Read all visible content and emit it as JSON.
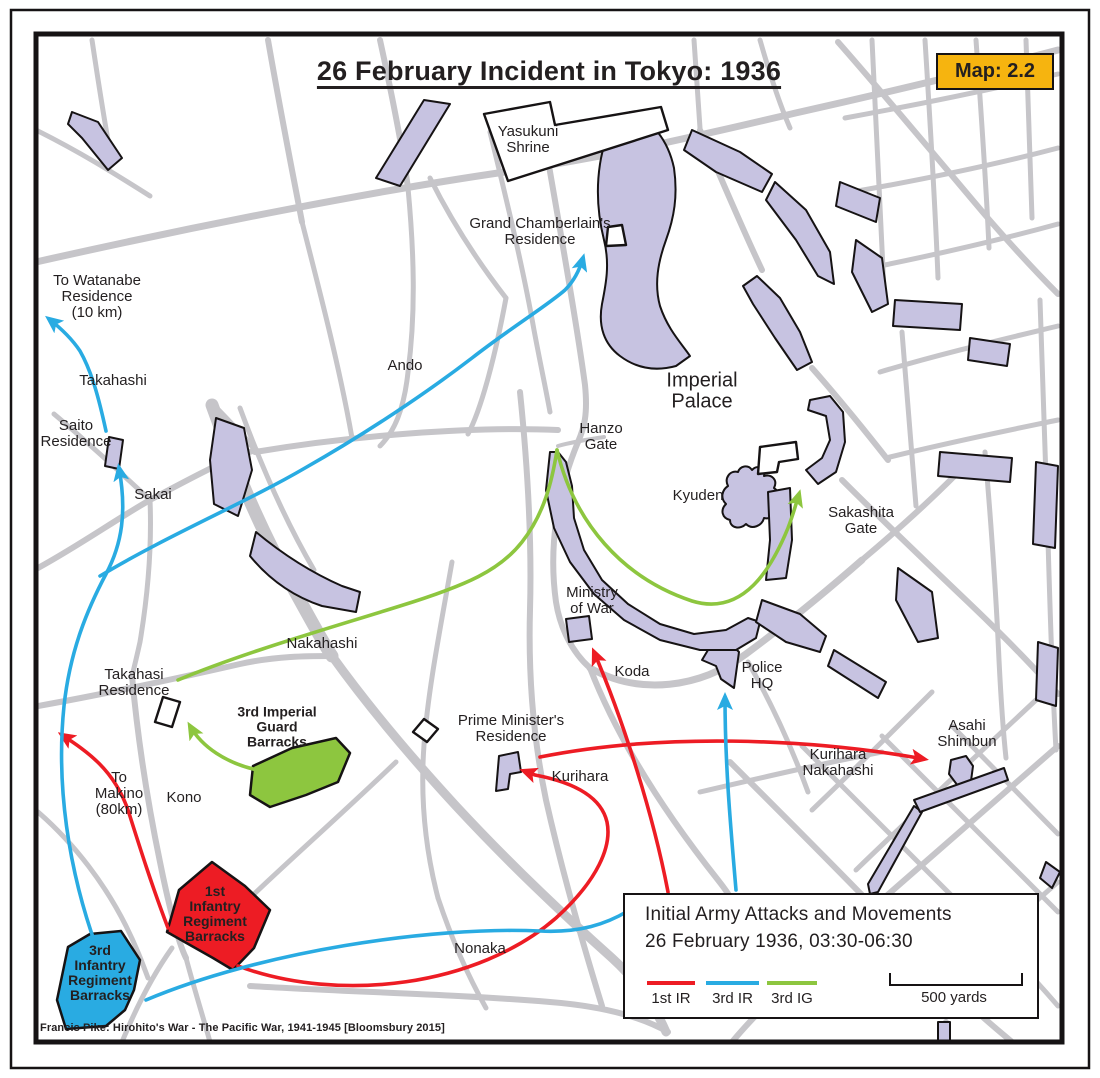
{
  "title": "26 February Incident in Tokyo: 1936",
  "badge": "Map: 2.2",
  "attribution": "Francis Pike:  Hirohito's War - The Pacific War, 1941-1945   [Bloomsbury 2015]",
  "colors": {
    "red": "#ed1c24",
    "blue": "#29abe2",
    "green": "#8dc63f",
    "lav": "#c7c3e1",
    "road": "#c6c5c9",
    "badge": "#f6b40f",
    "ink": "#231f20"
  },
  "legend": {
    "title_line1": "Initial Army Attacks and Movements",
    "title_line2": "26 February 1936, 03:30-06:30",
    "items": [
      {
        "label": "1st IR",
        "color": "red"
      },
      {
        "label": "3rd IR",
        "color": "blue"
      },
      {
        "label": "3rd IG",
        "color": "green"
      }
    ],
    "scale_label": "500 yards"
  },
  "labels": [
    {
      "name": "yasukuni-shrine",
      "text": "Yasukuni\nShrine",
      "x": 528,
      "y": 140
    },
    {
      "name": "grand-chamberlains-residence",
      "text": "Grand Chamberlain's\nResidence",
      "x": 540,
      "y": 232
    },
    {
      "name": "to-watanabe-residence",
      "text": "To Watanabe\nResidence\n(10 km)",
      "x": 97,
      "y": 297
    },
    {
      "name": "takahashi",
      "text": "Takahashi",
      "x": 113,
      "y": 381
    },
    {
      "name": "saito-residence",
      "text": "Saito\nResidence",
      "x": 76,
      "y": 434
    },
    {
      "name": "sakai",
      "text": "Sakai",
      "x": 153,
      "y": 495
    },
    {
      "name": "ando",
      "text": "Ando",
      "x": 405,
      "y": 366
    },
    {
      "name": "imperial-palace",
      "text": "Imperial\nPalace",
      "x": 702,
      "y": 392,
      "size": 20
    },
    {
      "name": "hanzo-gate",
      "text": "Hanzo\nGate",
      "x": 601,
      "y": 437
    },
    {
      "name": "kyuden",
      "text": "Kyuden",
      "x": 698,
      "y": 496
    },
    {
      "name": "sakashita-gate",
      "text": "Sakashita\nGate",
      "x": 861,
      "y": 521
    },
    {
      "name": "ministry-of-war",
      "text": "Ministry\nof War",
      "x": 592,
      "y": 601
    },
    {
      "name": "koda",
      "text": "Koda",
      "x": 632,
      "y": 672
    },
    {
      "name": "police-hq",
      "text": "Police\nHQ",
      "x": 762,
      "y": 676
    },
    {
      "name": "nakahashi",
      "text": "Nakahashi",
      "x": 322,
      "y": 644
    },
    {
      "name": "takahasi-residence",
      "text": "Takahasi\nResidence",
      "x": 134,
      "y": 683
    },
    {
      "name": "3rd-imperial-guard-barracks",
      "text": "3rd Imperial\nGuard\nBarracks",
      "x": 277,
      "y": 727,
      "bold": true,
      "size": 14
    },
    {
      "name": "prime-ministers-residence",
      "text": "Prime Minister's\nResidence",
      "x": 511,
      "y": 729
    },
    {
      "name": "kurihara",
      "text": "Kurihara",
      "x": 580,
      "y": 777
    },
    {
      "name": "kurihara-nakahashi",
      "text": "Kurihara\nNakahashi",
      "x": 838,
      "y": 763
    },
    {
      "name": "asahi-shimbun",
      "text": "Asahi\nShimbun",
      "x": 967,
      "y": 734
    },
    {
      "name": "to-makino",
      "text": "To\nMakino\n(80km)",
      "x": 119,
      "y": 794
    },
    {
      "name": "kono",
      "text": "Kono",
      "x": 184,
      "y": 798
    },
    {
      "name": "nonaka",
      "text": "Nonaka",
      "x": 480,
      "y": 949
    },
    {
      "name": "1st-infantry-regiment-barracks",
      "text": "1st\nInfantry\nRegiment\nBarracks",
      "x": 215,
      "y": 914,
      "bold": true,
      "size": 14
    },
    {
      "name": "3rd-infantry-regiment-barracks",
      "text": "3rd\nInfantry\nRegiment\nBarracks",
      "x": 100,
      "y": 973,
      "bold": true,
      "size": 14
    }
  ]
}
